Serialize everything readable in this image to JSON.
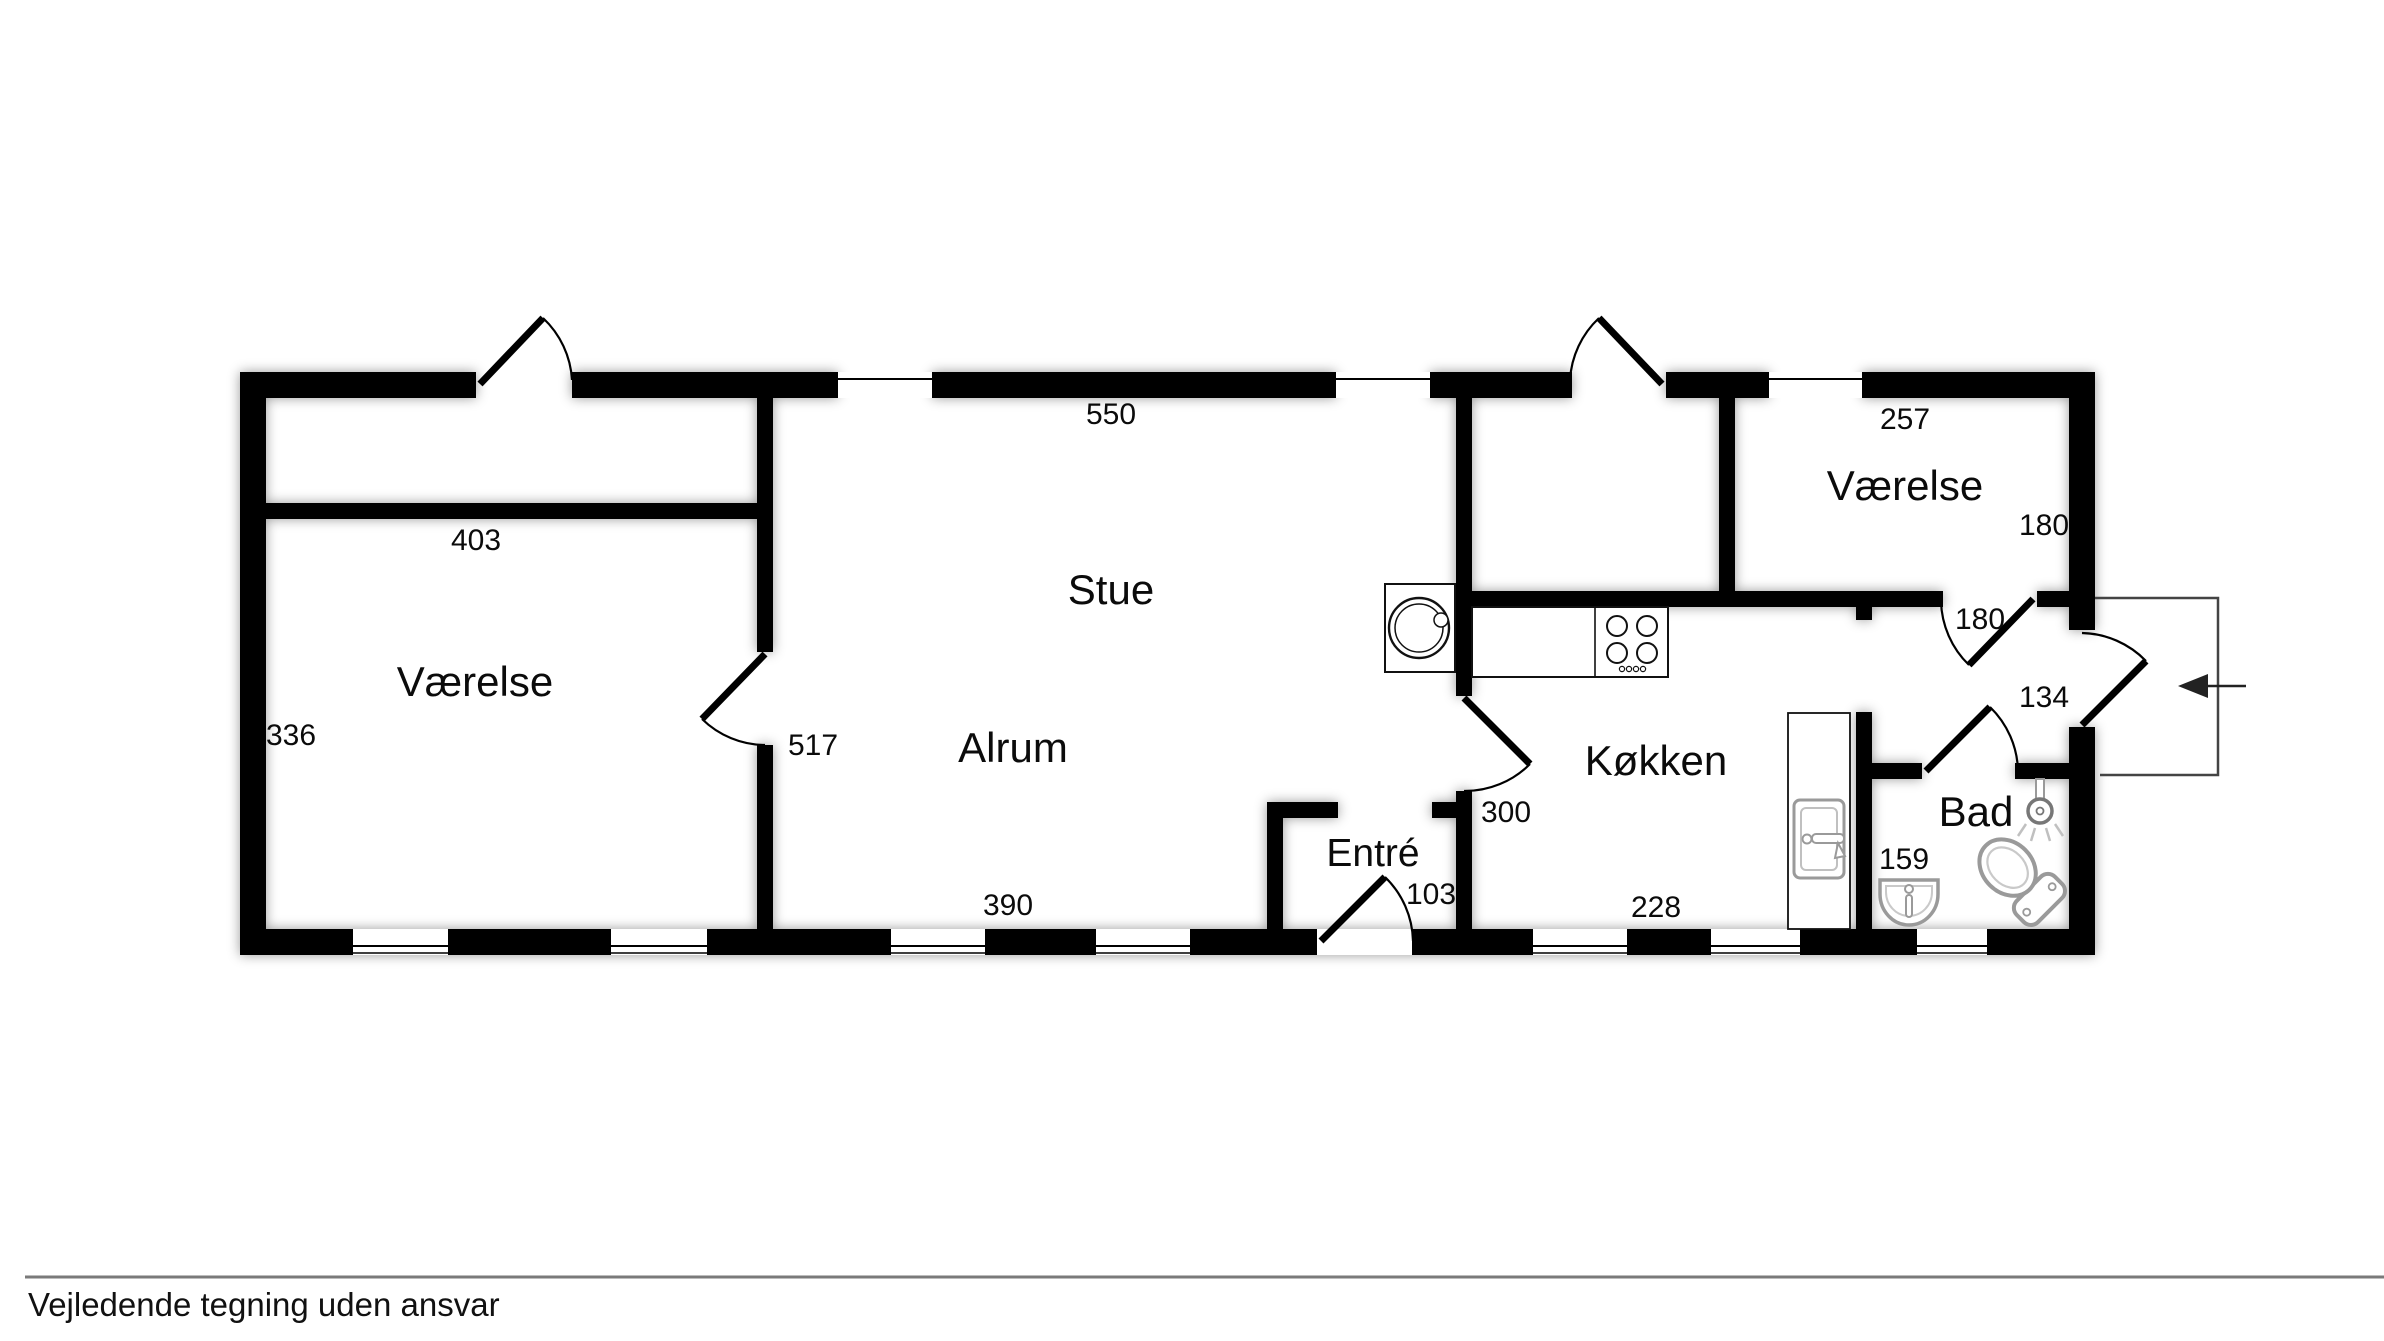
{
  "plan": {
    "rooms": {
      "vaerelse_left": {
        "name": "Værelse",
        "width": "403",
        "depth": "336"
      },
      "stue": {
        "name": "Stue",
        "width": "550"
      },
      "alrum": {
        "name": "Alrum",
        "width": "390",
        "wall": "517"
      },
      "entre": {
        "name": "Entré",
        "door": "103"
      },
      "koekken": {
        "name": "Køkken",
        "door": "300",
        "width": "228"
      },
      "vaerelse_right": {
        "name": "Værelse",
        "width": "257",
        "depth": "180"
      },
      "hall": {
        "door": "180"
      },
      "bad": {
        "name": "Bad",
        "sink": "159",
        "door": "134"
      }
    },
    "colors": {
      "wall": "#000000",
      "fixture_outline": "#9a9a9a",
      "divider_line": "#7a7a7a"
    }
  },
  "footer": {
    "disclaimer": "Vejledende tegning uden ansvar"
  }
}
